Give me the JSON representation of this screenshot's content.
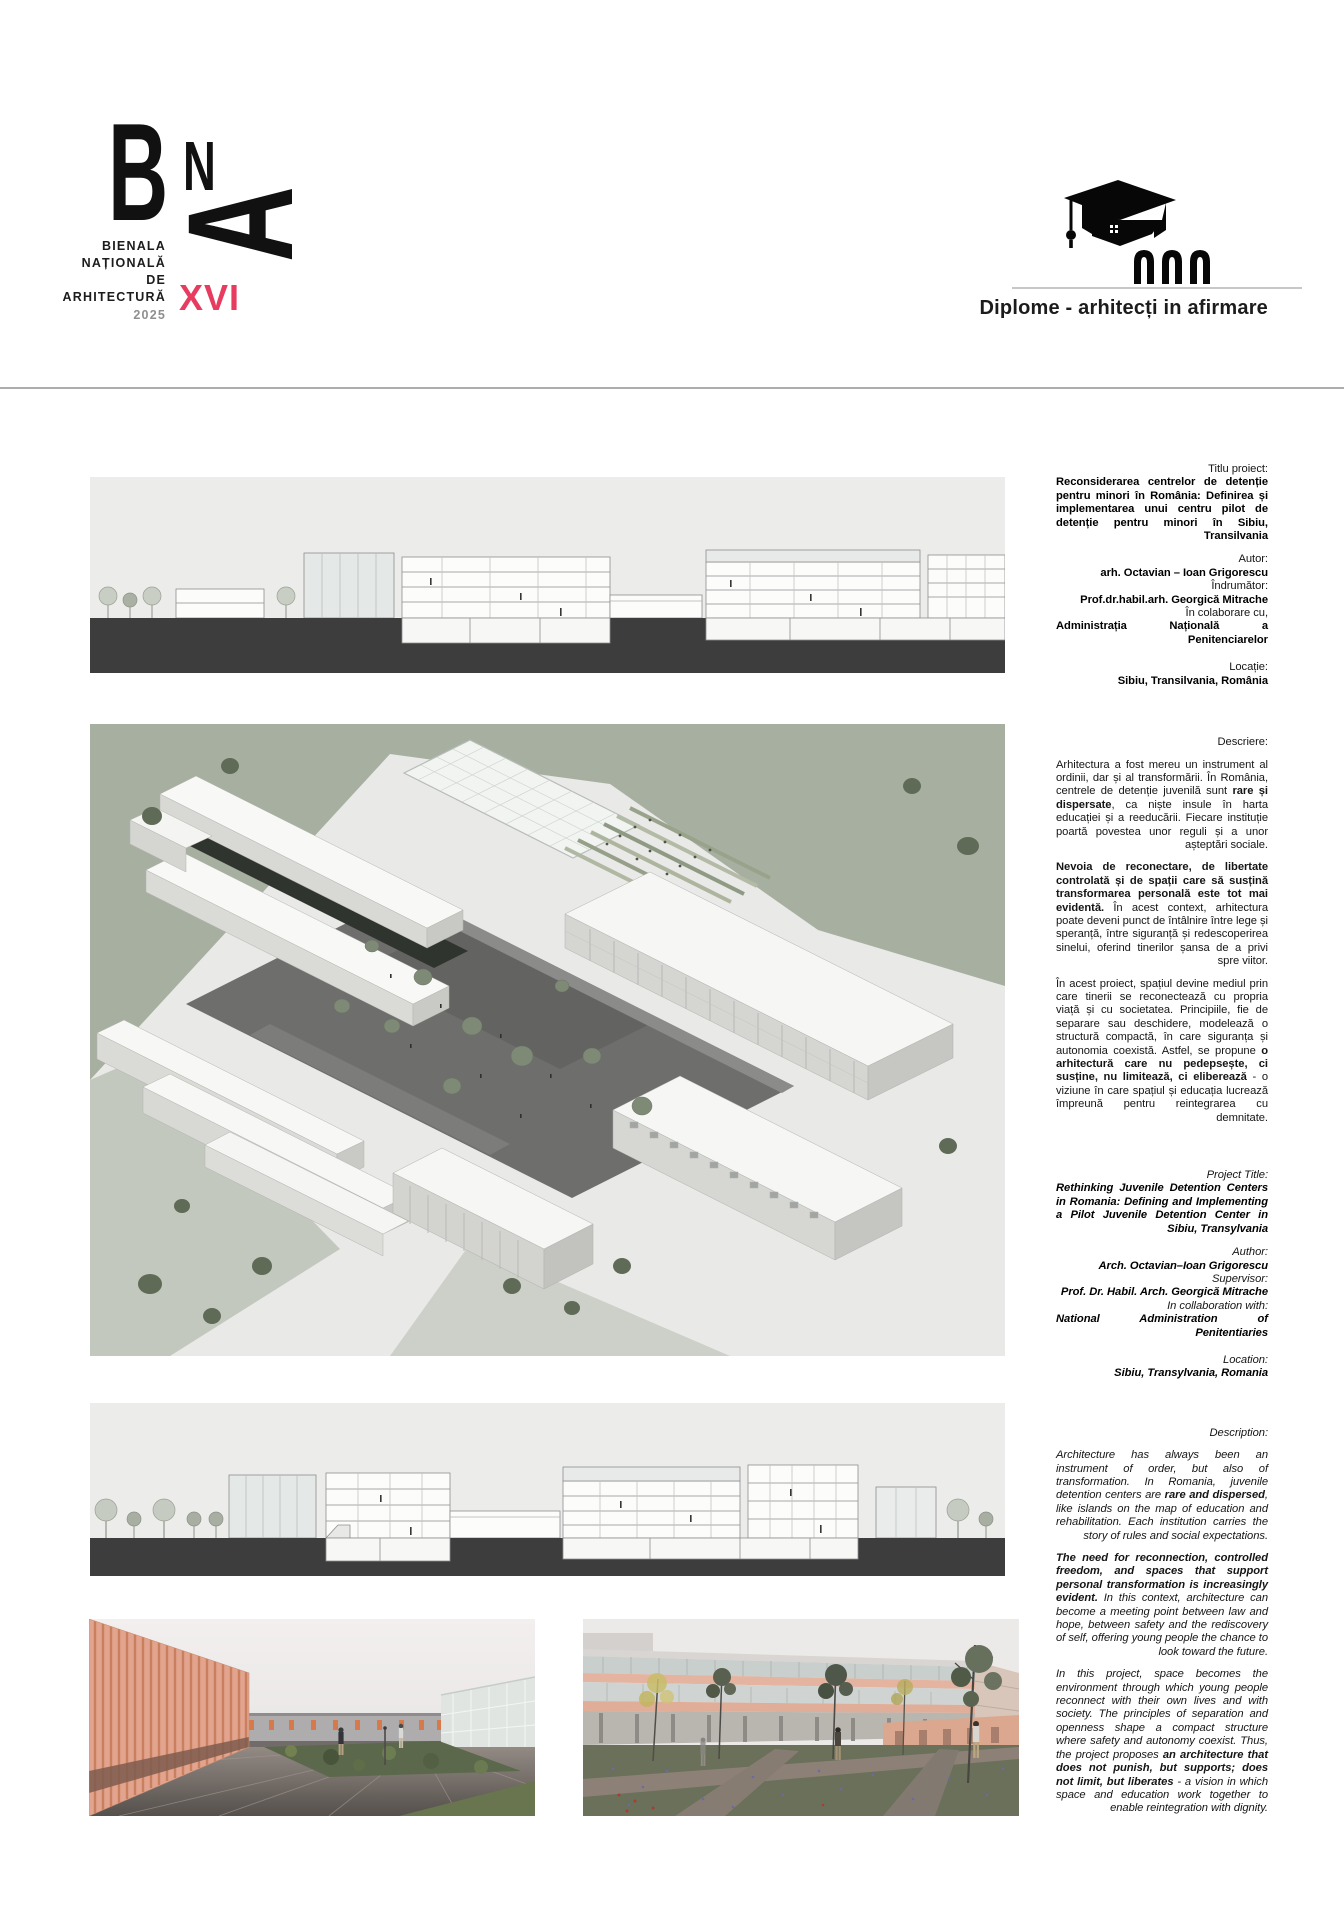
{
  "colors": {
    "accent_red": "#E73B5F",
    "text": "#1A1A1A",
    "panel_gray": "#ECECEB",
    "ground_dark": "#3D3D3D",
    "lawn_green": "#A7B0A0",
    "courtyard_gray": "#6E6E6C",
    "salmon": "#E2A48E"
  },
  "logo": {
    "letters": {
      "b": "B",
      "n": "N",
      "a": "A"
    },
    "lines": [
      "BIENALA",
      "NAȚIONALĂ",
      "DE",
      "ARHITECTURĂ"
    ],
    "year": "2025",
    "edition": "XVI"
  },
  "category": {
    "icon": "graduation-cap-arches-icon",
    "label": "Diplome - arhitecți in afirmare"
  },
  "info_ro": {
    "title_label": "Titlu proiect:",
    "title": "Reconsiderarea centrelor de detenție pentru minori în România: Definirea și implementarea unui centru pilot de detenție pentru minori în Sibiu, Transilvania",
    "author_label": "Autor:",
    "author": "arh. Octavian – Ioan Grigorescu",
    "supervisor_label": "Îndrumător:",
    "supervisor": "Prof.dr.habil.arh. Georgică Mitrache",
    "collab_label": "În colaborare cu,",
    "collab": "Administrația Națională a Penitenciarelor",
    "location_label": "Locație:",
    "location": "Sibiu, Transilvania, România",
    "description_label": "Descriere:",
    "paragraphs": [
      [
        {
          "t": "Arhitectura a fost mereu un instrument al ordinii, dar și al transformării. În România, centrele de detenție juvenilă sunt ",
          "b": false
        },
        {
          "t": "rare și dispersate",
          "b": true
        },
        {
          "t": ", ca niște insule în harta educației și a reeducării. Fiecare instituție poartă povestea unor reguli și a unor așteptări sociale.",
          "b": false
        }
      ],
      [
        {
          "t": "Nevoia de reconectare, de libertate controlată și de spații care să susțină transformarea personală este tot mai evidentă.",
          "b": true
        },
        {
          "t": " În acest context, arhitectura poate deveni punct de întâlnire între lege și speranță, între siguranță și redescoperirea sinelui, oferind tinerilor șansa de a privi spre viitor.",
          "b": false
        }
      ],
      [
        {
          "t": "În acest proiect, spațiul devine mediul prin care tinerii se reconectează cu propria viață și cu societatea. Principiile, fie de separare sau deschidere, modelează o structură compactă, în care siguranța și autonomia coexistă. Astfel, se propune ",
          "b": false
        },
        {
          "t": "o arhitectură care nu pedepsește, ci susține, nu limitează, ci eliberează",
          "b": true
        },
        {
          "t": " - o viziune în care spațiul și educația lucrează împreună pentru reintegrarea cu demnitate.",
          "b": false
        }
      ]
    ]
  },
  "info_en": {
    "title_label": "Project Title:",
    "title": "Rethinking Juvenile Detention Centers in Romania: Defining and Implementing a Pilot Juvenile Detention Center in Sibiu, Transylvania",
    "author_label": "Author:",
    "author": "Arch. Octavian–Ioan Grigorescu",
    "supervisor_label": "Supervisor:",
    "supervisor": "Prof. Dr. Habil. Arch. Georgică Mitrache",
    "collab_label": "In collaboration with:",
    "collab": "National Administration of Penitentiaries",
    "location_label": "Location:",
    "location": "Sibiu, Transylvania, Romania",
    "description_label": "Description:",
    "paragraphs": [
      [
        {
          "t": "Architecture has always been an instrument of order, but also of transformation. In Romania, juvenile detention centers are ",
          "b": false
        },
        {
          "t": "rare and dispersed",
          "b": true
        },
        {
          "t": ", like islands on the map of education and rehabilitation. Each institution carries the story of rules and social expectations.",
          "b": false
        }
      ],
      [
        {
          "t": "The need for reconnection, controlled freedom, and spaces that support personal transformation is increasingly evident.",
          "b": true
        },
        {
          "t": " In this context, architecture can become a meeting point between law and hope, between safety and the rediscovery of self, offering young people the chance to look toward the future.",
          "b": false
        }
      ],
      [
        {
          "t": "In this project, space becomes the environment through which young people reconnect with their own lives and with society. The principles of separation and openness shape a compact structure where safety and autonomy coexist. Thus, the project proposes ",
          "b": false
        },
        {
          "t": "an architecture that does not punish, but supports; does not limit, but liberates",
          "b": true
        },
        {
          "t": " - a vision in which space and education work together to enable reintegration with dignity.",
          "b": false
        }
      ]
    ]
  }
}
